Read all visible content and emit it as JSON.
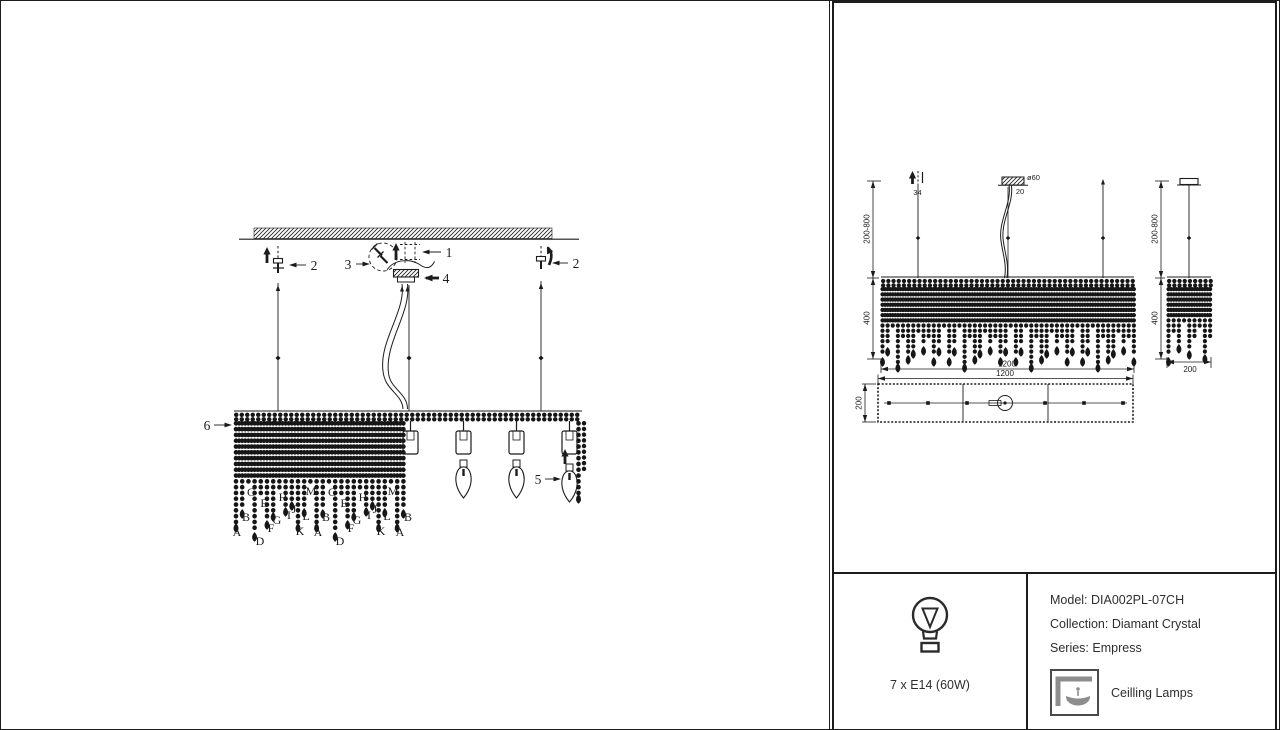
{
  "colors": {
    "ink": "#1c1c1c",
    "bead": "#161616",
    "gray_icon": "#8d8d8d"
  },
  "assembly": {
    "callouts": [
      {
        "n": "1",
        "lx": 448,
        "ly": 256,
        "x1": 440,
        "y1": 251,
        "x2": 421,
        "y2": 251,
        "bold": false
      },
      {
        "n": "2",
        "lx": 313,
        "ly": 269,
        "x1": 305,
        "y1": 264,
        "x2": 288,
        "y2": 264,
        "bold": false
      },
      {
        "n": "2",
        "lx": 575,
        "ly": 267,
        "x1": 567,
        "y1": 262,
        "x2": 551,
        "y2": 262,
        "bold": false
      },
      {
        "n": "3",
        "lx": 347,
        "ly": 268,
        "x1": 355,
        "y1": 263,
        "x2": 369,
        "y2": 263,
        "bold": false
      },
      {
        "n": "4",
        "lx": 445,
        "ly": 282,
        "x1": 438,
        "y1": 277,
        "x2": 423,
        "y2": 277,
        "bold": true
      },
      {
        "n": "5",
        "lx": 537,
        "ly": 483,
        "x1": 544,
        "y1": 478,
        "x2": 560,
        "y2": 478,
        "bold": false
      },
      {
        "n": "6",
        "lx": 206,
        "ly": 429,
        "x1": 213,
        "y1": 424,
        "x2": 231,
        "y2": 424,
        "bold": false
      }
    ],
    "letters": [
      {
        "t": "A",
        "x": 236,
        "y": 535
      },
      {
        "t": "B",
        "x": 245,
        "y": 520
      },
      {
        "t": "C",
        "x": 250,
        "y": 495
      },
      {
        "t": "D",
        "x": 259,
        "y": 544
      },
      {
        "t": "E",
        "x": 263,
        "y": 506
      },
      {
        "t": "F",
        "x": 270,
        "y": 531
      },
      {
        "t": "G",
        "x": 276,
        "y": 523
      },
      {
        "t": "H",
        "x": 282,
        "y": 500
      },
      {
        "t": "I",
        "x": 288,
        "y": 518
      },
      {
        "t": "J",
        "x": 293,
        "y": 512
      },
      {
        "t": "K",
        "x": 299,
        "y": 534
      },
      {
        "t": "L",
        "x": 305,
        "y": 519
      },
      {
        "t": "M",
        "x": 310,
        "y": 494
      },
      {
        "t": "A",
        "x": 317,
        "y": 535
      },
      {
        "t": "B",
        "x": 325,
        "y": 520
      },
      {
        "t": "C",
        "x": 331,
        "y": 495
      },
      {
        "t": "D",
        "x": 339,
        "y": 544
      },
      {
        "t": "E",
        "x": 343,
        "y": 506
      },
      {
        "t": "F",
        "x": 350,
        "y": 531
      },
      {
        "t": "G",
        "x": 356,
        "y": 523
      },
      {
        "t": "H",
        "x": 362,
        "y": 500
      },
      {
        "t": "I",
        "x": 368,
        "y": 518
      },
      {
        "t": "J",
        "x": 374,
        "y": 512
      },
      {
        "t": "K",
        "x": 380,
        "y": 534
      },
      {
        "t": "L",
        "x": 386,
        "y": 519
      },
      {
        "t": "M",
        "x": 392,
        "y": 494
      },
      {
        "t": "A",
        "x": 399,
        "y": 535
      },
      {
        "t": "B",
        "x": 407,
        "y": 520
      }
    ]
  },
  "front_view": {
    "h_top": "200-800",
    "h_panel": "400",
    "w_panel": "1200",
    "hook": "34",
    "canopy_d": "ø60",
    "canopy_h": "20"
  },
  "side_view": {
    "h_top": "200-800",
    "h_panel": "400",
    "w": "200"
  },
  "plan_view": {
    "w": "1200",
    "d": "200"
  },
  "info": {
    "bulb_caption": "7 x E14 (60W)",
    "model": "Model: DIA002PL-07CH",
    "collection": "Collection: Diamant Crystal",
    "series": "Series: Empress",
    "category": "Ceilling Lamps"
  }
}
